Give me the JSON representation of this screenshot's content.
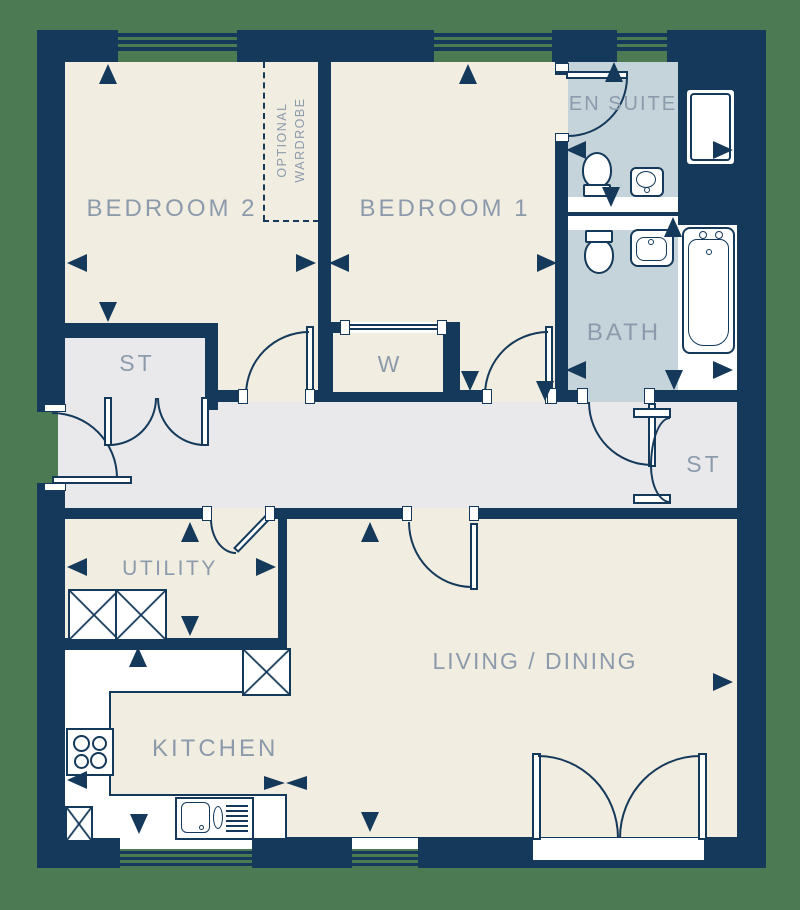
{
  "title": "Apartment floor plan",
  "colors": {
    "background_green": "#4C7A52",
    "wall_navy": "#14395A",
    "room_cream": "#F2EDE1",
    "hall_grey": "#E9E9EB",
    "bathroom_blue": "#C5D3DB",
    "label_grey": "#8C9BAC",
    "fixture_white": "#FFFFFF"
  },
  "rooms": {
    "bedroom2": {
      "label": "BEDROOM 2"
    },
    "bedroom1": {
      "label": "BEDROOM 1"
    },
    "ensuite": {
      "label": "EN SUITE"
    },
    "bath": {
      "label": "BATH"
    },
    "storage_left": {
      "label": "ST"
    },
    "storage_right": {
      "label": "ST"
    },
    "wardrobe": {
      "label": "W"
    },
    "utility": {
      "label": "UTILITY"
    },
    "kitchen": {
      "label": "KITCHEN"
    },
    "living_dining": {
      "label": "LIVING / DINING"
    },
    "optional_wardrobe": {
      "line1": "OPTIONAL",
      "line2": "WARDROBE"
    }
  },
  "arrows": [
    {
      "d": "up",
      "x": 99,
      "y": 64
    },
    {
      "d": "left",
      "x": 67,
      "y": 254
    },
    {
      "d": "right",
      "x": 296,
      "y": 254
    },
    {
      "d": "left",
      "x": 329,
      "y": 254
    },
    {
      "d": "up",
      "x": 459,
      "y": 64
    },
    {
      "d": "right",
      "x": 537,
      "y": 254
    },
    {
      "d": "up",
      "x": 605,
      "y": 62
    },
    {
      "d": "left",
      "x": 566,
      "y": 141
    },
    {
      "d": "down",
      "x": 602,
      "y": 187
    },
    {
      "d": "right",
      "x": 713,
      "y": 141
    },
    {
      "d": "up",
      "x": 664,
      "y": 217
    },
    {
      "d": "left",
      "x": 566,
      "y": 361
    },
    {
      "d": "down",
      "x": 665,
      "y": 370
    },
    {
      "d": "right",
      "x": 713,
      "y": 361
    },
    {
      "d": "down",
      "x": 99,
      "y": 302
    },
    {
      "d": "down",
      "x": 461,
      "y": 371
    },
    {
      "d": "down",
      "x": 536,
      "y": 381
    },
    {
      "d": "up",
      "x": 181,
      "y": 522
    },
    {
      "d": "left",
      "x": 67,
      "y": 558
    },
    {
      "d": "right",
      "x": 256,
      "y": 558
    },
    {
      "d": "down",
      "x": 181,
      "y": 616
    },
    {
      "d": "up",
      "x": 129,
      "y": 647
    },
    {
      "d": "up",
      "x": 361,
      "y": 522
    },
    {
      "d": "left",
      "x": 67,
      "y": 771
    },
    {
      "d": "down",
      "x": 130,
      "y": 814
    },
    {
      "d": "right",
      "x": 264,
      "y": 776,
      "s": "sm"
    },
    {
      "d": "left",
      "x": 286,
      "y": 776,
      "s": "sm"
    },
    {
      "d": "down",
      "x": 361,
      "y": 812
    },
    {
      "d": "right",
      "x": 713,
      "y": 673
    }
  ]
}
